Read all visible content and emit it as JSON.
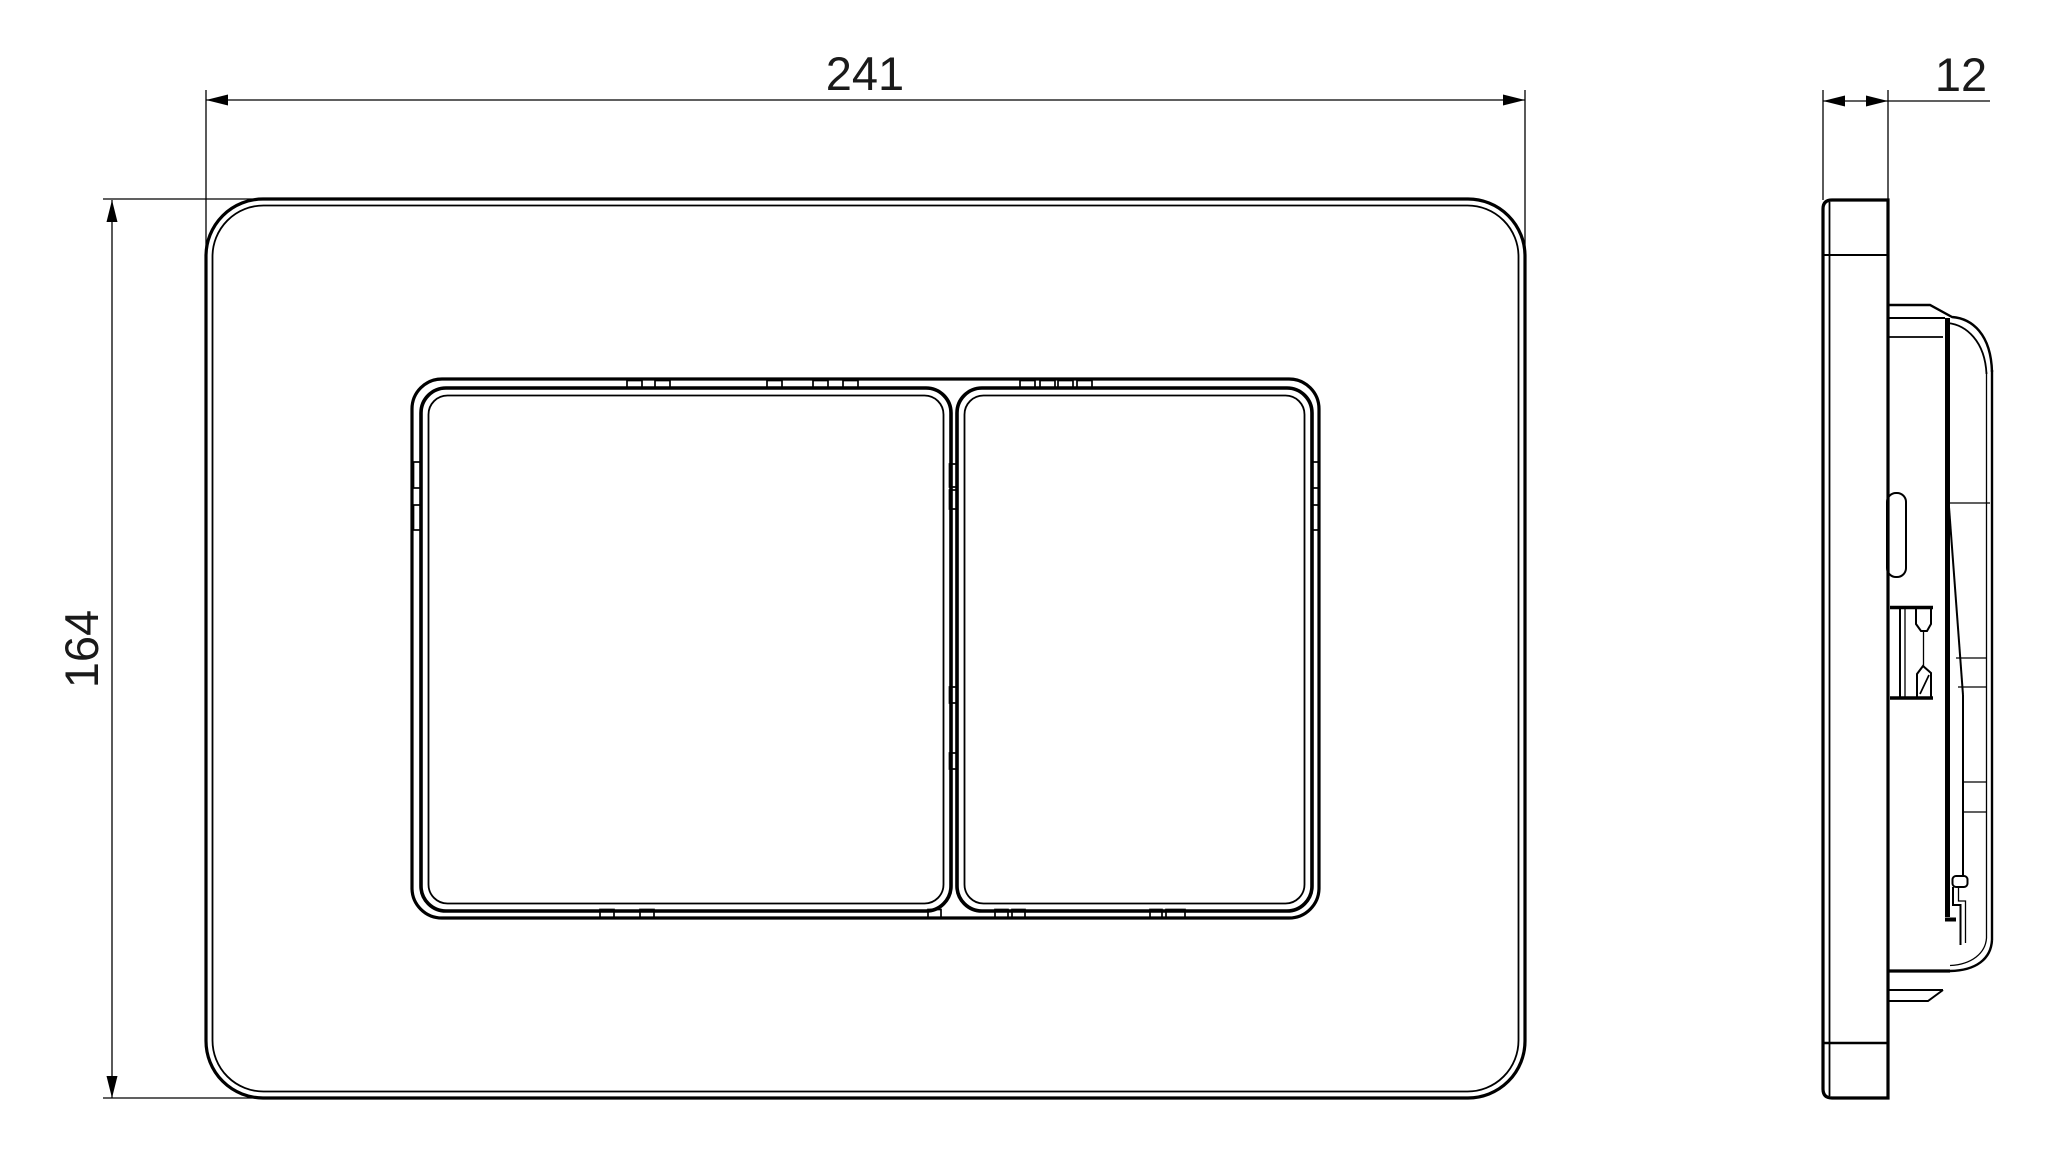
{
  "drawing": {
    "kind": "technical dimension drawing, front view and side view",
    "colors": {
      "line": "#000000",
      "background": "#ffffff",
      "text": "#1a1a1a"
    },
    "dimensions": {
      "front_width": {
        "label": "241"
      },
      "front_height": {
        "label": "164"
      },
      "side_depth": {
        "label": "12"
      }
    }
  }
}
